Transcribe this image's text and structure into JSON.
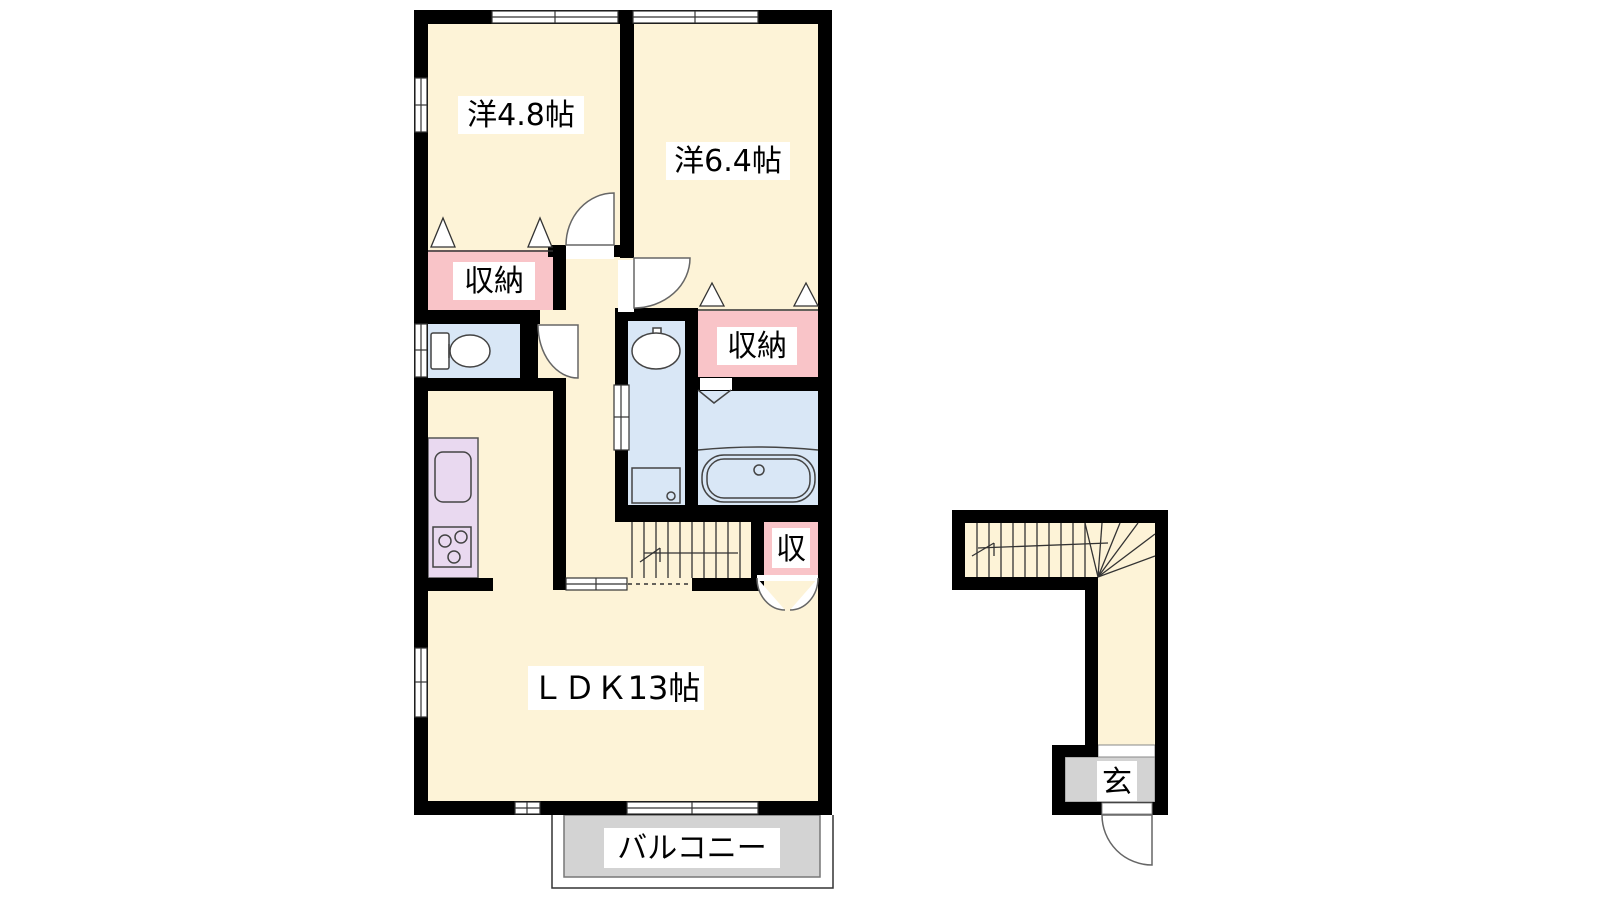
{
  "labels": {
    "room_48": "洋4.8帖",
    "room_64": "洋6.4帖",
    "storage_left": "収納",
    "storage_right": "収納",
    "storage_small": "収",
    "ldk": "ＬＤＫ13帖",
    "balcony": "バルコニー",
    "entrance": "玄"
  },
  "colors": {
    "wall": "#000000",
    "floor": "#fdf3d7",
    "storage": "#f9c4c8",
    "water": "#d9e7f6",
    "kitchen": "#e9d9f0",
    "terrace": "#d3d3d3",
    "white": "#ffffff"
  }
}
